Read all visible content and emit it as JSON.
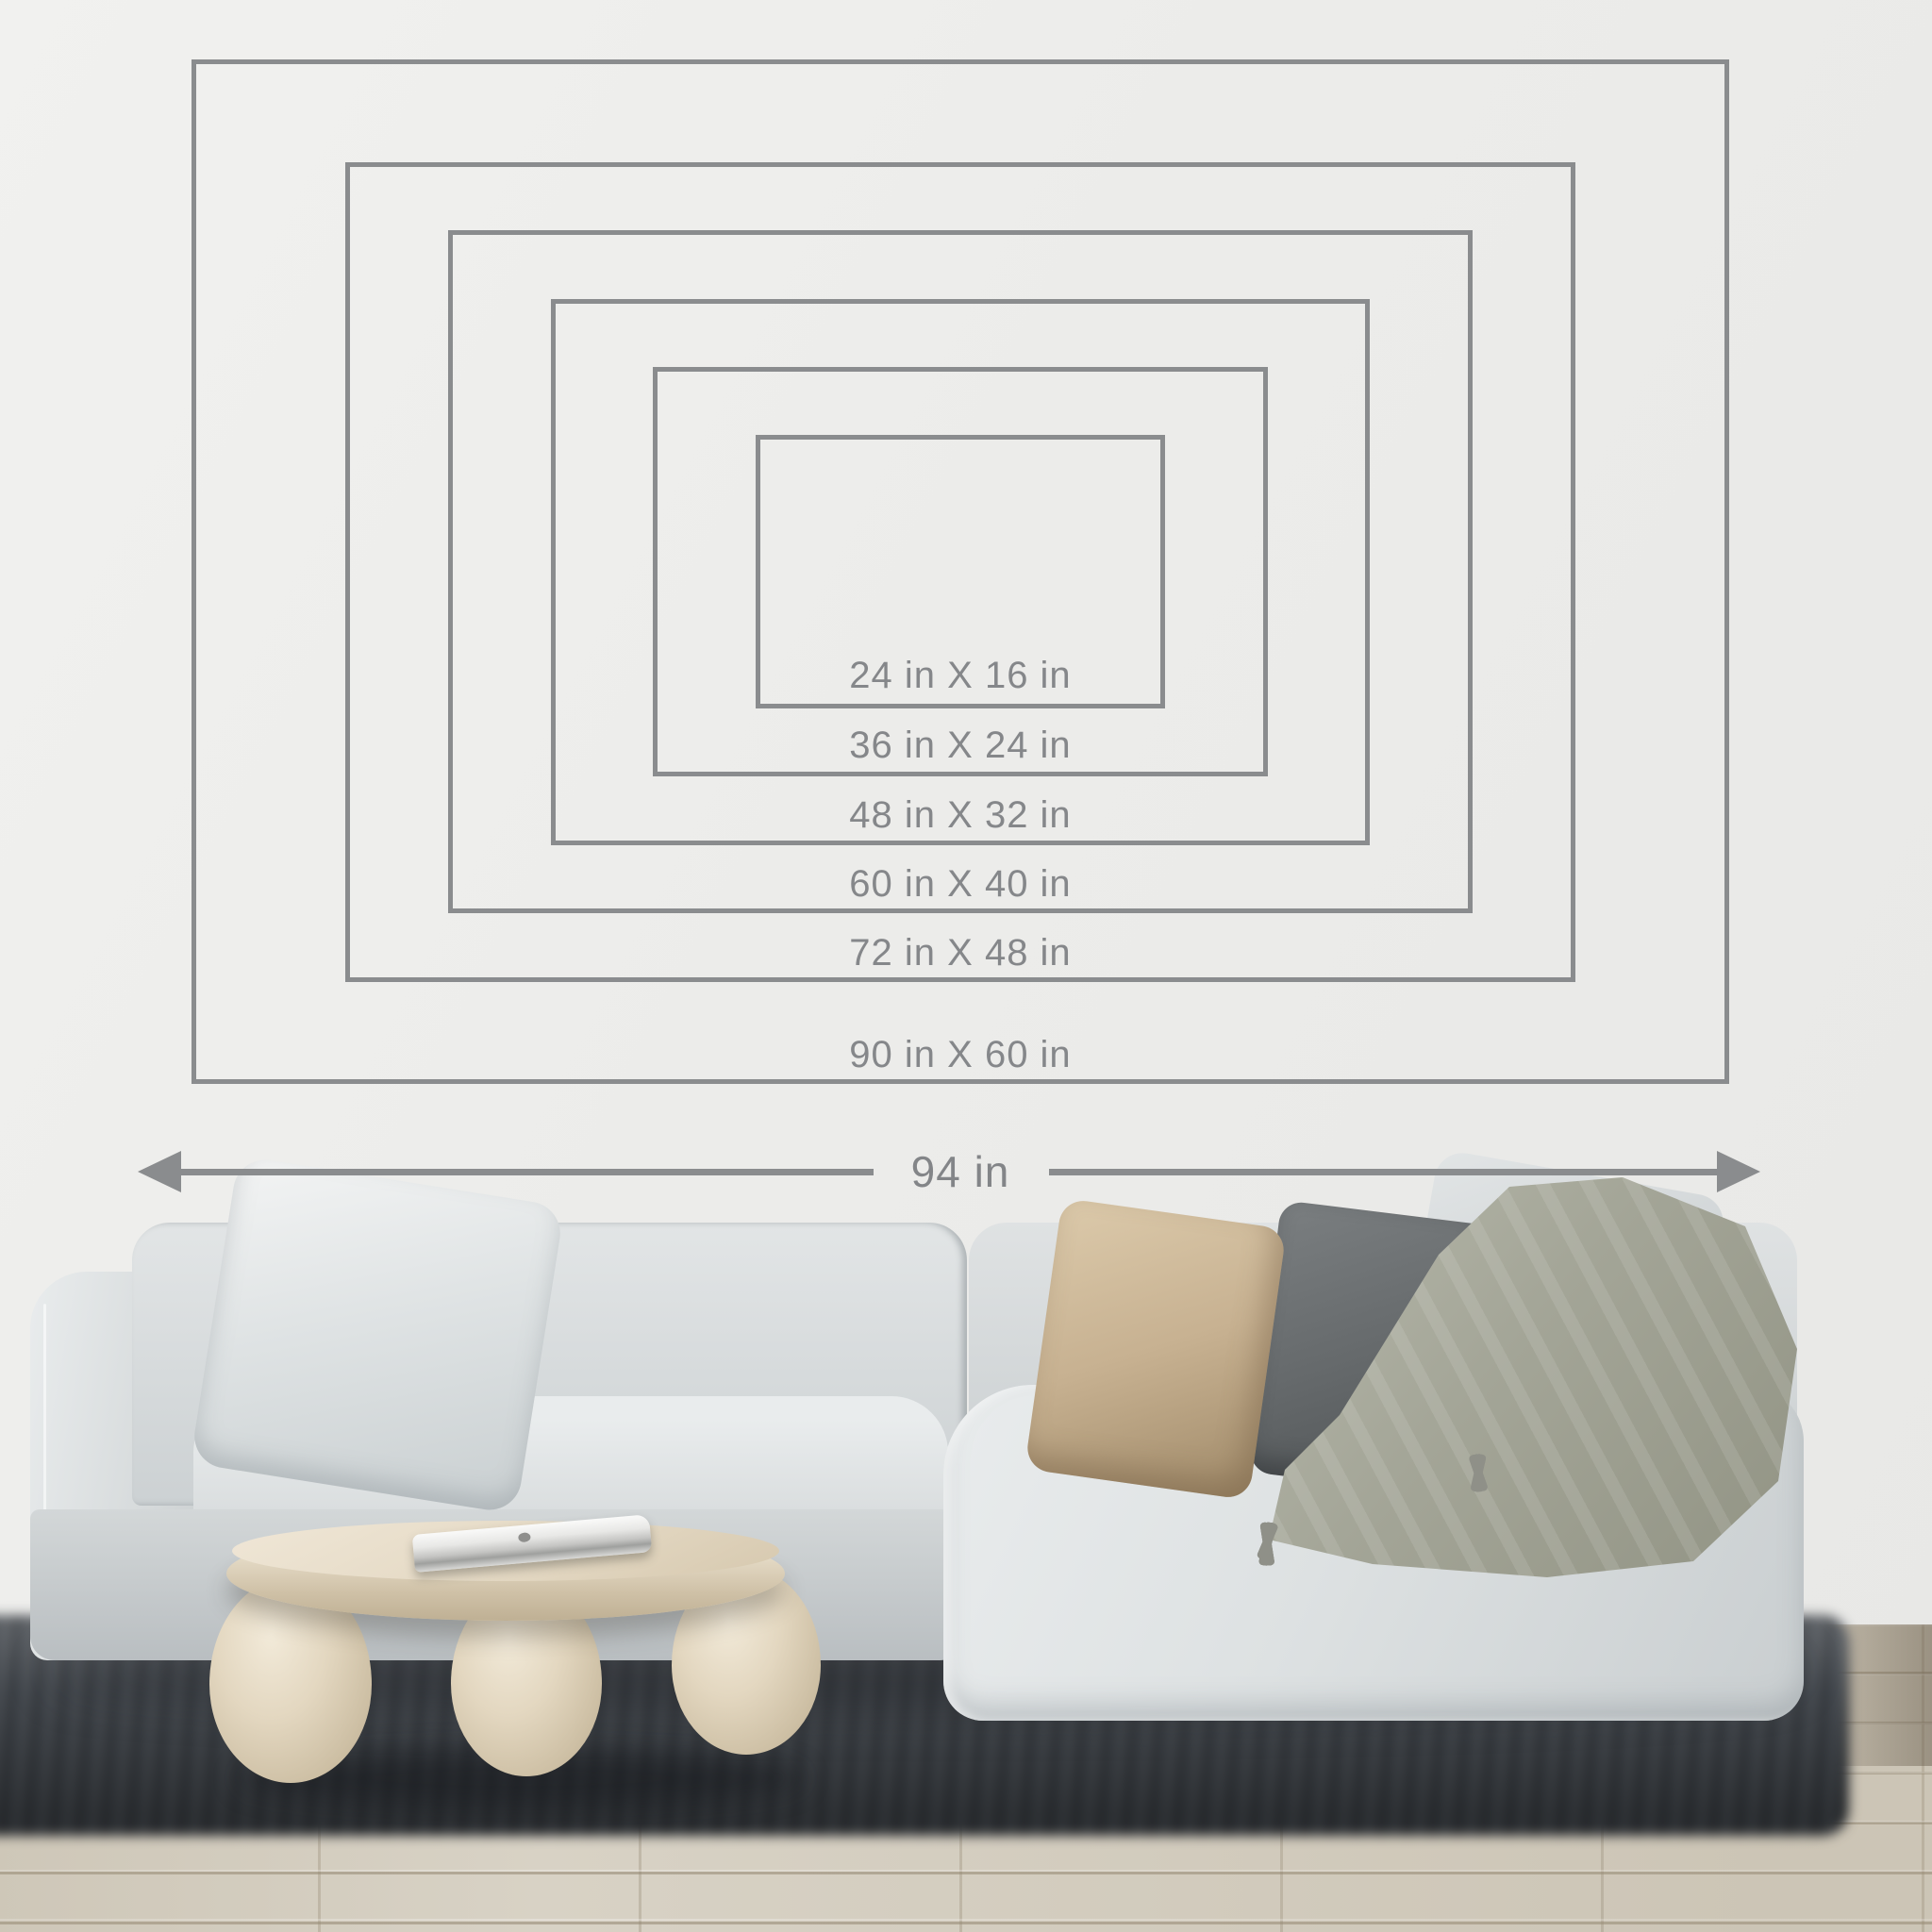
{
  "size_chart": {
    "unit": "in",
    "sizes": [
      {
        "width_in": 24,
        "height_in": 16,
        "label": "24 in X 16 in"
      },
      {
        "width_in": 36,
        "height_in": 24,
        "label": "36 in X 24 in"
      },
      {
        "width_in": 48,
        "height_in": 32,
        "label": "48 in X 32 in"
      },
      {
        "width_in": 60,
        "height_in": 40,
        "label": "60 in X 40 in"
      },
      {
        "width_in": 72,
        "height_in": 48,
        "label": "72 in X 48 in"
      },
      {
        "width_in": 90,
        "height_in": 60,
        "label": "90 in X 60 in"
      }
    ],
    "span_label": "94 in",
    "span_in": 94
  },
  "colors": {
    "outline": "#8a8c8e",
    "label_text": "#85878a",
    "arrow": "#8a8c8e",
    "wall": "#ececea",
    "floor_wood": "#d8d2c5",
    "rug": "#41464c",
    "sofa_fabric": "#d6dadb",
    "pillow_beige": "#c7b191",
    "pillow_dark": "#666a6c",
    "pillow_light": "#ccd1d3",
    "throw": "#93948c",
    "table": "#e4d9c4",
    "laptop": "#e8e8e6"
  }
}
